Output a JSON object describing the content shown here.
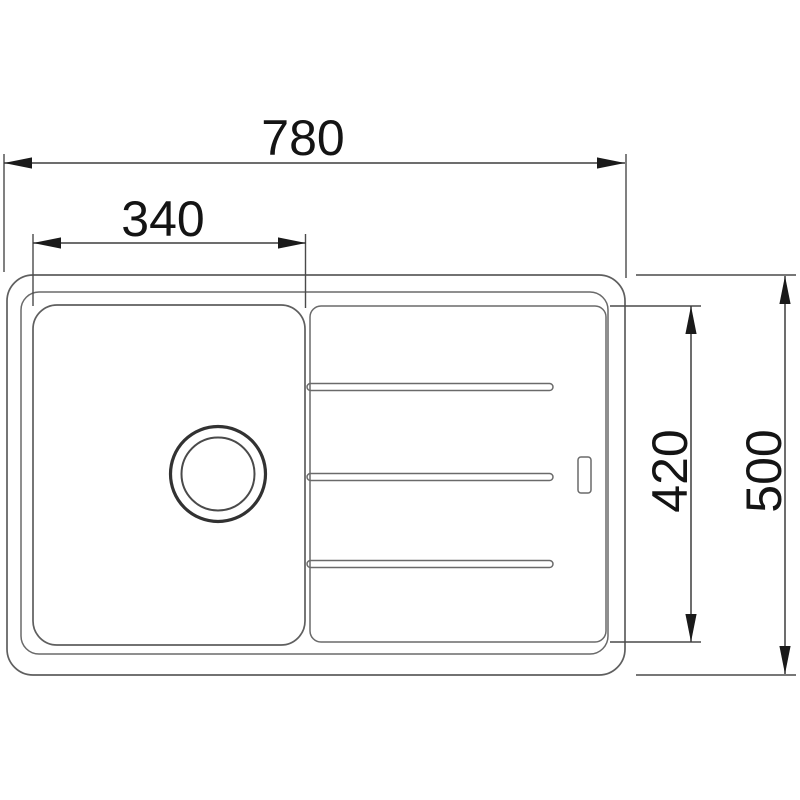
{
  "page": {
    "background_color": "#ffffff",
    "description": "Technical top-view dimension drawing of a kitchen sink with single bowl and drainboard"
  },
  "drawing": {
    "colors": {
      "outline": "#5f5f5f",
      "dimension_line": "#3d3d3d",
      "arrow": "#1a1a1a",
      "text": "#141414"
    },
    "dimensions": {
      "overall_width": {
        "value": "780"
      },
      "bowl_width": {
        "value": "340"
      },
      "inner_depth": {
        "value": "420"
      },
      "overall_depth": {
        "value": "500"
      }
    },
    "features": {
      "groove_count": 3,
      "drain": "circular-drain",
      "overflow": "overflow-slot"
    }
  }
}
